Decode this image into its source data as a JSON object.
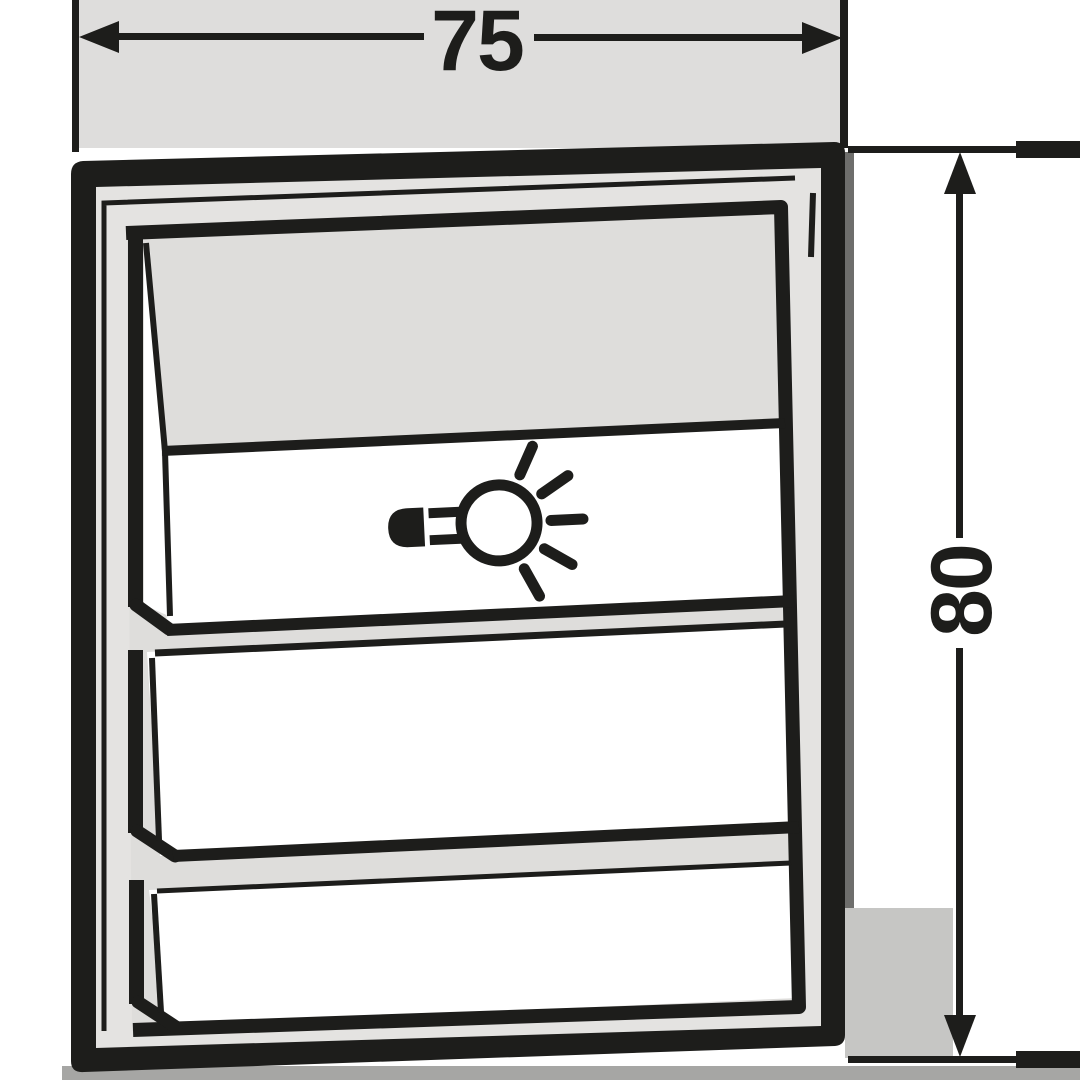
{
  "diagram": {
    "type": "technical-dimension-drawing",
    "width_dimension": {
      "label": "75"
    },
    "height_dimension": {
      "label": "80"
    },
    "device": {
      "kind": "switch-front-view",
      "rocker_count": 3,
      "top_rocker_icon": "light-icon"
    },
    "colors": {
      "line": "#1d1d1b",
      "faceplate": "#e4e3e1",
      "panel_top_gray": "#dedddb",
      "top_band": "#dedddc",
      "right_patch": "#c6c6c4",
      "bottom_strip": "#a6a6a4",
      "side_shadow": "#6e6e6c",
      "panel_face": "#ffffff"
    }
  }
}
